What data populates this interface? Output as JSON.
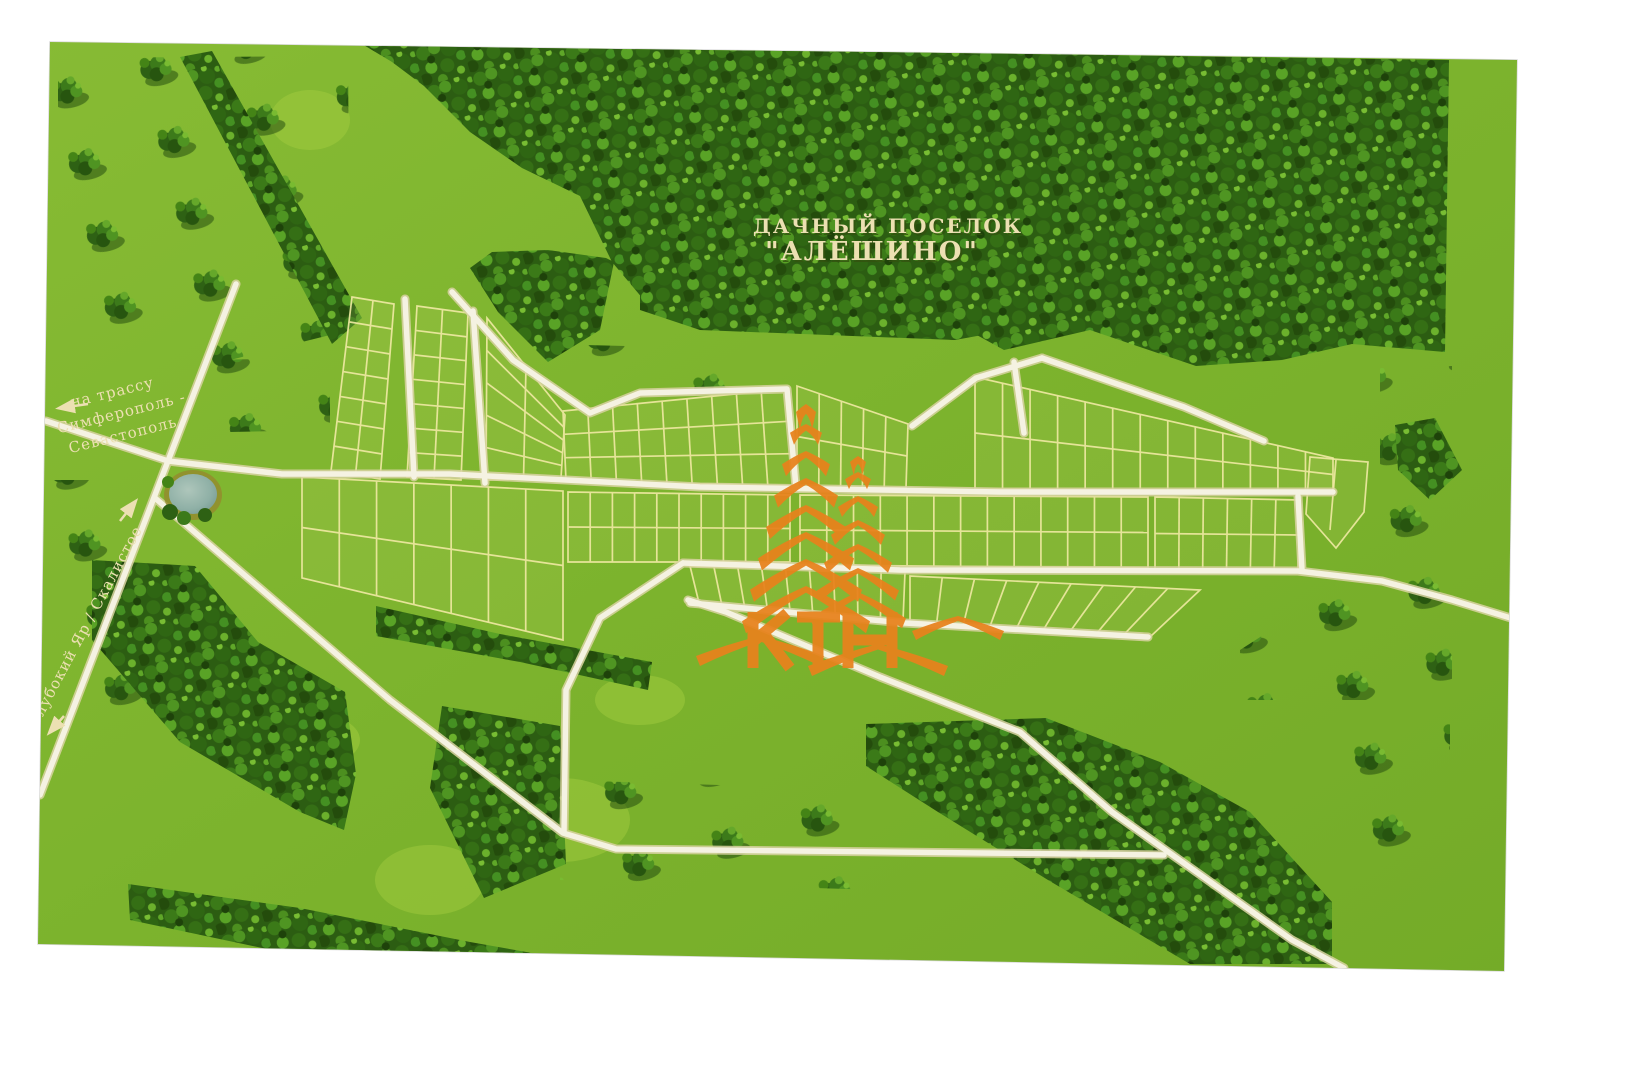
{
  "map": {
    "title": {
      "line1": "ДАЧНЫЙ ПОСЕЛОК",
      "line2": "\"АЛЁШИНО\""
    },
    "labels": {
      "highway_line1": "на трассу",
      "highway_line2": "Симферополь -",
      "highway_line3": "Севастополь",
      "road_sw": "Глубокий Яр / Скалистое"
    },
    "logo": {
      "text": "КТН"
    },
    "colors": {
      "field_green": "#7cb32d",
      "forest_green": "#2c5d12",
      "plot_line": "#efe9a2",
      "road_fill": "#f5f2e2",
      "label_cream": "#ece0b2",
      "logo_orange": "#e8821c",
      "pond_blue": "#8fb0a6"
    }
  }
}
